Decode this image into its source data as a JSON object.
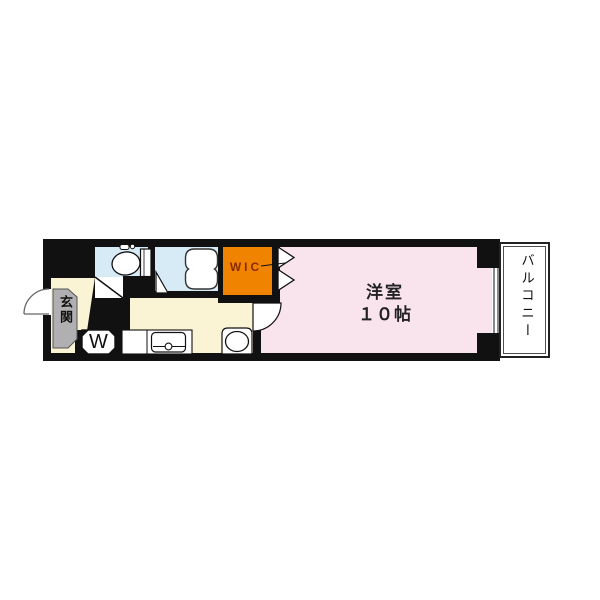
{
  "floor_plan": {
    "entrance": {
      "label": "玄関"
    },
    "washer_space": {
      "label": "W"
    },
    "wic": {
      "label": "WIC"
    },
    "main_room": {
      "name": "洋室",
      "size": "１０帖"
    },
    "balcony": {
      "label": "バルコニー"
    },
    "colors": {
      "wall": "#111111",
      "kitchen_hall_floor": "#faf3d4",
      "wet_area_floor": "#d6ebf5",
      "wic_fill": "#f08300",
      "main_room_floor": "#f9e3ec",
      "entrance_fill": "#b0b0b3",
      "wic_text": "#8b2a00",
      "background": "#ffffff"
    },
    "icons": [
      "toilet-icon",
      "bathtub-icon",
      "kitchen-sink-icon",
      "washbasin-icon",
      "entrance-door-swing-icon",
      "room-door-swing-icon",
      "toilet-door-icon",
      "bath-door-icon",
      "folding-door-icon",
      "window-icon"
    ]
  }
}
